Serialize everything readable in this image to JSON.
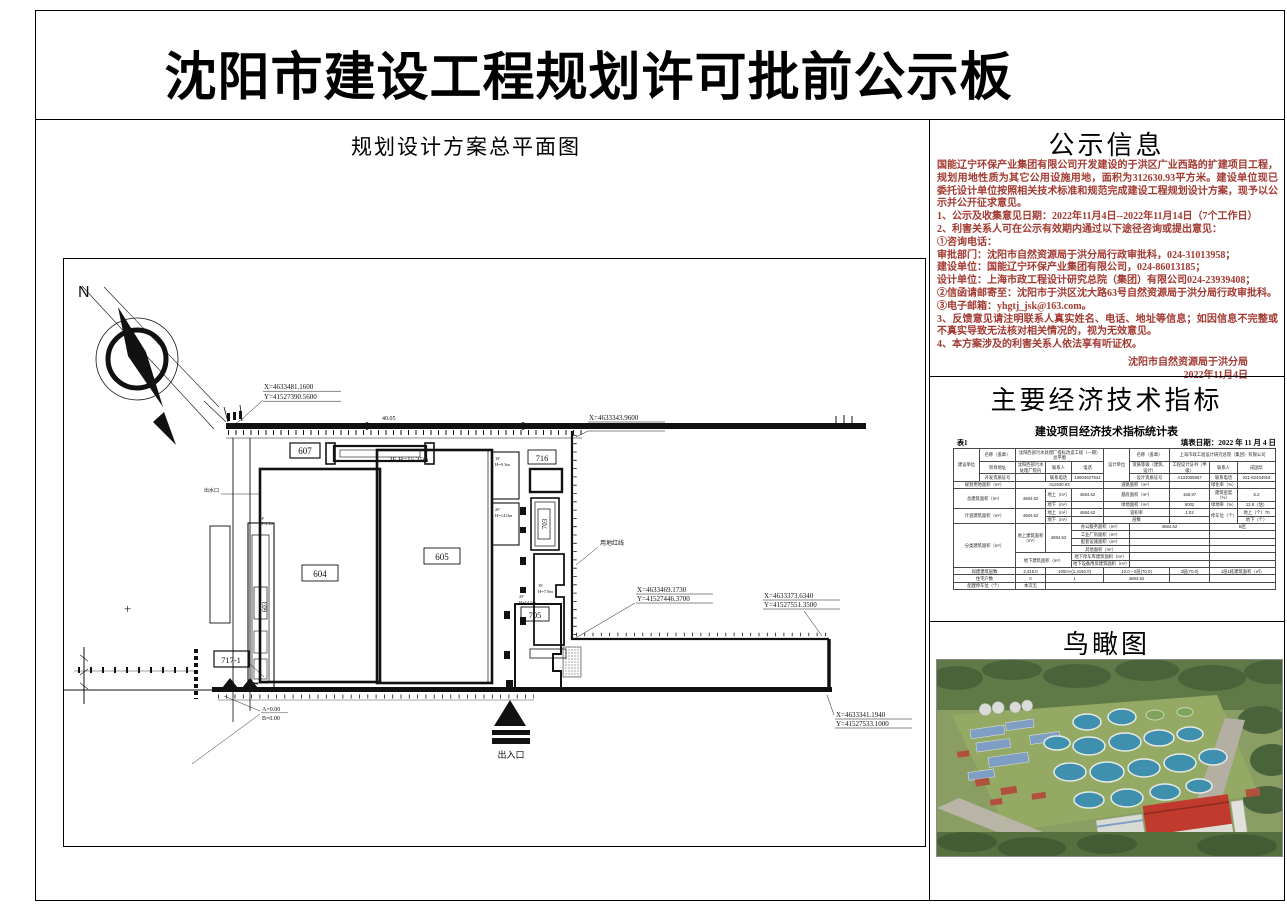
{
  "sheet": {
    "title": "沈阳市建设工程规划许可批前公示板"
  },
  "plan": {
    "section_title": "规划设计方案总平面图",
    "north": "N",
    "dim_top": "40.05",
    "coord1_x": "X=4633481.1600",
    "coord1_y": "Y=41527390.5600",
    "coord2_x": "X=4633343.9600",
    "coord2_y": "Y=41527526.5200",
    "coord3_x": "X=4633469.1730",
    "coord3_y": "Y=41527446.3700",
    "coord4_x": "X=4633373.6340",
    "coord4_y": "Y=41527551.3500",
    "coord5_x": "X=4633341.1940",
    "coord5_y": "Y=41527533.1000",
    "b603": "603",
    "b604": "604",
    "b605": "605",
    "b607": "607",
    "b705": "705",
    "b716": "716",
    "b703": "703",
    "b717": "717-1",
    "ann_605": "3F H=15.35m",
    "ann_1f93_a": "1F",
    "ann_1f93_b": "H=9.3m",
    "ann_2f14_a": "2F",
    "ann_2f14_b": "H=14.0m",
    "ann_1f79_a": "1F",
    "ann_1f79_b": "H=7.9m",
    "ann_2f146_a": "2F",
    "ann_2f146_b": "H=14.6m",
    "ann_603_a": "1F",
    "ann_603_b": "H=4.5m",
    "red_line_label": "用地红线",
    "outfall_label": "出水口",
    "level_a": "A=0.00",
    "level_b": "B=0.00",
    "entrance_label": "出入口",
    "plus_mark": "+"
  },
  "notice": {
    "heading": "公示信息",
    "text_color": "#a33a32",
    "paragraphs": [
      "国能辽宁环保产业集团有限公司开发建设的于洪区广业西路的扩建项目工程，规划用地性质为其它公用设施用地，面积为312630.93平方米。建设单位现已委托设计单位按照相关技术标准和规范完成建设工程规划设计方案，现予以公示并公开征求意见。",
      "1、公示及收集意见日期：2022年11月4日--2022年11月14日（7个工作日）",
      "2、利害关系人可在公示有效期内通过以下途径咨询或提出意见：",
      "①咨询电话：",
      "审批部门：沈阳市自然资源局于洪分局行政审批科，024-31013958；",
      "建设单位：国能辽宁环保产业集团有限公司，024-86013185；",
      "设计单位：上海市政工程设计研究总院（集团）有限公司024-23939408；",
      "②信函请邮寄至：沈阳市于洪区沈大路63号自然资源局于洪分局行政审批科。",
      "③电子邮箱：yhgtj_jsk@163.com。",
      "3、反馈意见请注明联系人真实姓名、电话、地址等信息；如因信息不完整或不真实导致无法核对相关情况的，视为无效意见。",
      "4、本方案涉及的利害关系人依法享有听证权。"
    ],
    "signature": "沈阳市自然资源局于洪分局",
    "signature_date": "2022年11月4日"
  },
  "indicators": {
    "heading": "主要经济技术指标",
    "table_title": "建设项目经济技术指标统计表",
    "table_no": "表1",
    "date_label": "填表日期：2022 年 11 月 4 日",
    "table_rows": [
      [
        {
          "t": "建设单位",
          "r": 3
        },
        {
          "t": "名称（盖章）"
        },
        {
          "t": "沈阳西部污水处理厂提标改造工程（一期）总平图",
          "c": 3
        },
        {
          "t": "设计单位",
          "r": 3
        },
        {
          "t": "名称（盖章）"
        },
        {
          "t": "上海市政工程设计研究总院（集团）有限公司",
          "c": 3
        }
      ],
      [
        {
          "t": "项目地址"
        },
        {
          "t": "沈阳西部污水处理厂院内"
        },
        {
          "t": "联系人"
        },
        {
          "t": "电话"
        },
        {
          "t": "资质等级（建筑、设计）"
        },
        {
          "t": "工程设计证书（甲级）"
        },
        {
          "t": "联系人"
        },
        {
          "t": "成国华"
        }
      ],
      [
        {
          "t": "开发资质证号"
        },
        {
          "t": ""
        },
        {
          "t": "联系电话"
        },
        {
          "t": "13604927544"
        },
        {
          "t": "设计资质证号"
        },
        {
          "t": "A131005957"
        },
        {
          "t": "联系电话"
        },
        {
          "t": "021-62404918"
        }
      ],
      [
        {
          "t": "规划用地面积（m²）",
          "c": 2
        },
        {
          "t": "312630.93",
          "c": 3
        },
        {
          "t": "道路面积（m²）",
          "c": 2
        },
        {
          "t": ""
        },
        {
          "t": "绿化率（%）"
        },
        {
          "t": ""
        }
      ],
      [
        {
          "t": "总建筑面积（m²）",
          "c": 2,
          "r": 2
        },
        {
          "t": "4684.62",
          "r": 2
        },
        {
          "t": "地上（m²）"
        },
        {
          "t": "4684.62"
        },
        {
          "t": "基底面积（m²）",
          "c": 2
        },
        {
          "t": "156.97"
        },
        {
          "t": "建筑密度（%）"
        },
        {
          "t": "5.2"
        }
      ],
      [
        {
          "t": "地下（m²）"
        },
        {
          "t": ""
        },
        {
          "t": "绿地面积（m²）",
          "c": 2
        },
        {
          "t": "6002"
        },
        {
          "t": "绿地率（%）"
        },
        {
          "t": "12.8（估）"
        }
      ],
      [
        {
          "t": "计容建筑面积（m²）",
          "c": 2,
          "r": 2
        },
        {
          "t": "4684.62",
          "r": 2
        },
        {
          "t": "地上（m²）"
        },
        {
          "t": "4684.62"
        },
        {
          "t": "容积率",
          "c": 2
        },
        {
          "t": "1.02"
        },
        {
          "t": "停车位（个）",
          "r": 2
        },
        {
          "t": "地上（个）70"
        }
      ],
      [
        {
          "t": "地下（m²）"
        },
        {
          "t": ""
        },
        {
          "t": "层数",
          "c": 2
        },
        {
          "t": ""
        },
        {
          "t": "地下（个）"
        }
      ],
      [
        {
          "t": "分类建筑面积（m²）",
          "c": 2,
          "r": 6
        },
        {
          "t": "地上建筑面积（m²）",
          "r": 4
        },
        {
          "t": "4684.62",
          "r": 4
        },
        {
          "t": "办公服务面积（m²）",
          "c": 2
        },
        {
          "t": "4684.62",
          "c": 2
        },
        {
          "t": "B区",
          "c": 2
        }
      ],
      [
        {
          "t": "工业厂房面积（m²）",
          "c": 2
        },
        {
          "t": "",
          "c": 2
        },
        {
          "t": "",
          "c": 2
        }
      ],
      [
        {
          "t": "配套设施面积（m²）",
          "c": 2
        },
        {
          "t": "",
          "c": 2
        },
        {
          "t": "",
          "c": 2
        }
      ],
      [
        {
          "t": "其他面积（m²）",
          "c": 2
        },
        {
          "t": "",
          "c": 2
        },
        {
          "t": "",
          "c": 2
        }
      ],
      [
        {
          "t": "地下建筑面积（m²）",
          "c": 2,
          "r": 2
        },
        {
          "t": "地下停车库建筑面积（m²）",
          "c": 2
        },
        {
          "t": "",
          "c": 2
        },
        {
          "t": "",
          "c": 2
        }
      ],
      [
        {
          "t": "地下设备用房建筑面积（m²）",
          "c": 2
        },
        {
          "t": "",
          "c": 2
        },
        {
          "t": "",
          "c": 2
        }
      ],
      [
        {
          "t": "拟建建筑层数",
          "c": 2
        },
        {
          "t": "2,415.0"
        },
        {
          "t": "100m×(1,4150.0)",
          "c": 2
        },
        {
          "t": "10.0－2层(70.0)",
          "c": 2
        },
        {
          "t": "3层(70.0)"
        },
        {
          "t": "1层1栋建筑面积（㎡）",
          "c": 2
        }
      ],
      [
        {
          "t": "住宅户数",
          "c": 2
        },
        {
          "t": "0"
        },
        {
          "t": "1",
          "c": 2
        },
        {
          "t": "4684.62",
          "c": 2
        },
        {
          "t": ""
        },
        {
          "t": "",
          "c": 2
        }
      ],
      [
        {
          "t": "配建停车位（个）",
          "c": 2
        },
        {
          "t": "本次无"
        },
        {
          "t": "",
          "c": 7
        }
      ]
    ]
  },
  "aerial": {
    "heading": "鸟瞰图"
  }
}
